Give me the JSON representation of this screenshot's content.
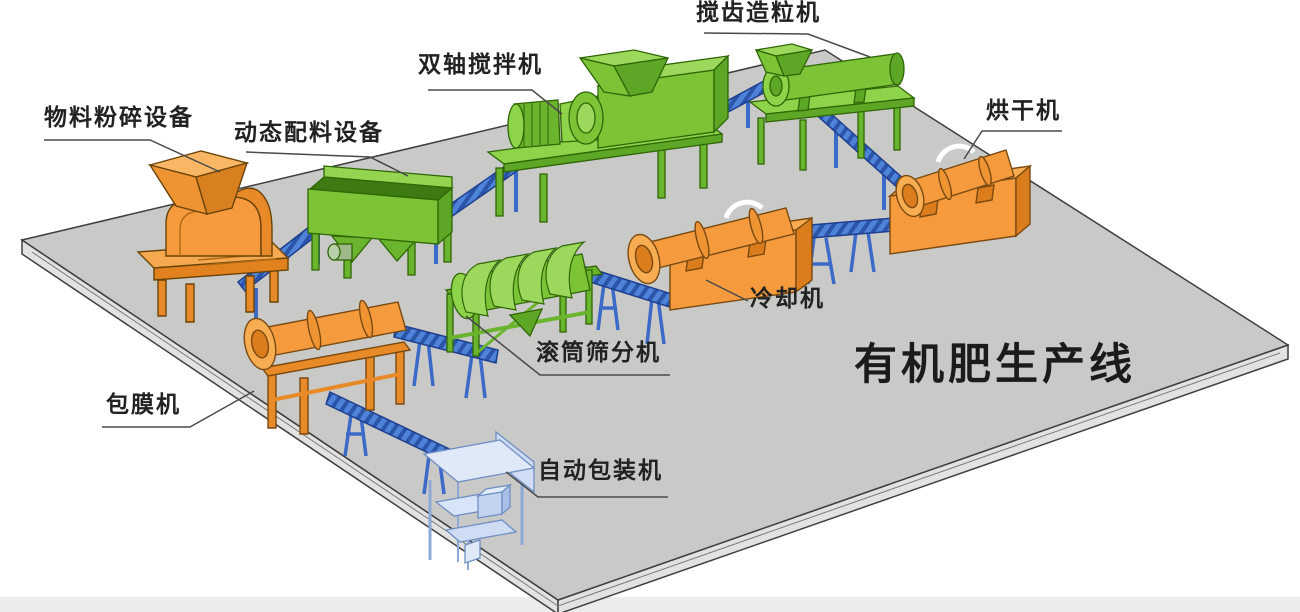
{
  "diagram": {
    "title": "有机肥生产线",
    "machines": [
      {
        "id": "crusher",
        "label": "物料粉碎设备",
        "color": "orange"
      },
      {
        "id": "batcher",
        "label": "动态配料设备",
        "color": "green"
      },
      {
        "id": "mixer",
        "label": "双轴搅拌机",
        "color": "green"
      },
      {
        "id": "granulator",
        "label": "搅齿造粒机",
        "color": "green"
      },
      {
        "id": "dryer",
        "label": "烘干机",
        "color": "orange"
      },
      {
        "id": "cooler",
        "label": "冷却机",
        "color": "orange"
      },
      {
        "id": "screener",
        "label": "滚筒筛分机",
        "color": "green"
      },
      {
        "id": "coater",
        "label": "包膜机",
        "color": "orange"
      },
      {
        "id": "packer",
        "label": "自动包装机",
        "color": "light-blue"
      }
    ],
    "palette": {
      "machine_orange": "#F59B3E",
      "machine_orange_dark": "#DB7D1C",
      "machine_green": "#7CC436",
      "machine_green_dark": "#5EA626",
      "conveyor_blue": "#4A80D8",
      "packer_blue": "#D8E5F8",
      "platform_gray": "#C9C9C7",
      "platform_edge": "#3F3F3F",
      "background": "#FFFFFF",
      "label_color": "#222222",
      "title_color": "#1B1B1B",
      "leader_line": "#4A4A4A"
    }
  }
}
